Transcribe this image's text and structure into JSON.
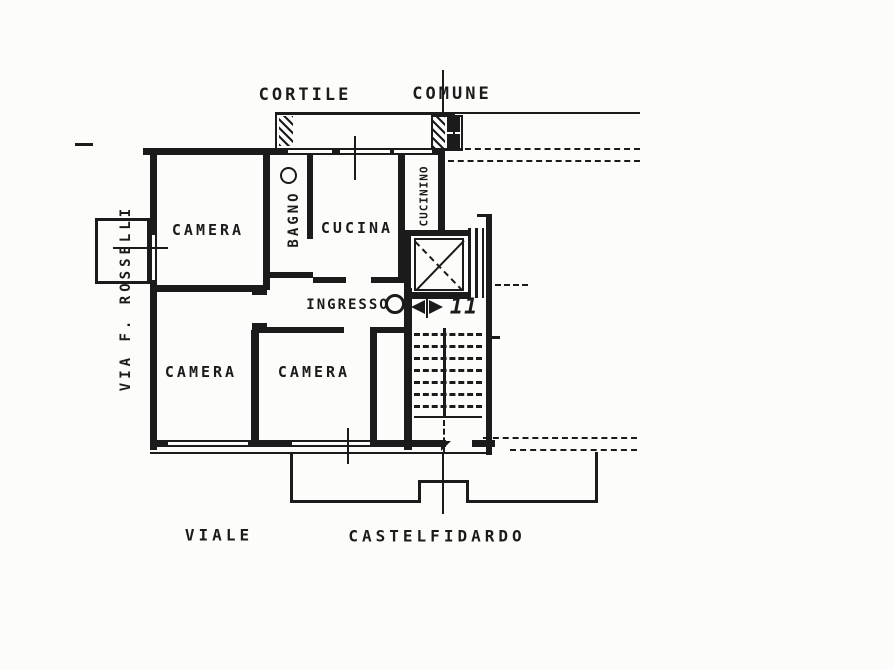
{
  "floorplan": {
    "colors": {
      "ink": "#1b1b1b",
      "paper": "#fcfcfa"
    },
    "exterior": {
      "courtyard_word1": "CORTILE",
      "courtyard_word2": "COMUNE",
      "street_left": "VIA F. ROSSELLI",
      "street_bottom_word1": "VIALE",
      "street_bottom_word2": "CASTELFIDARDO"
    },
    "rooms": {
      "camera_nw": "CAMERA",
      "bagno": "BAGNO",
      "cucina": "CUCINA",
      "cucinino": "CUCININO",
      "ingresso": "INGRESSO",
      "camera_sw": "CAMERA",
      "camera_s": "CAMERA"
    },
    "unit_number": "11"
  }
}
